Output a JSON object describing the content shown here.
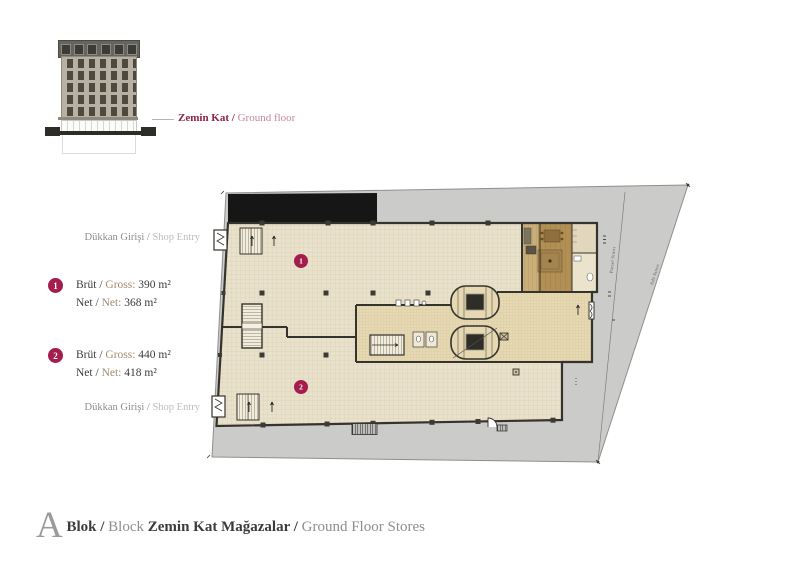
{
  "elevation": {
    "callout_bold": "Zemin Kat /",
    "callout_light": " Ground floor"
  },
  "legend": {
    "items": [
      {
        "number": "1",
        "line1_dark": "Brüt / ",
        "line1_light": "Gross: ",
        "line1_value": "390 m²",
        "line2_dark": "Net / ",
        "line2_light": "Net: ",
        "line2_value": "368 m²"
      },
      {
        "number": "2",
        "line1_dark": "Brüt / ",
        "line1_light": "Gross: ",
        "line1_value": "440 m²",
        "line2_dark": "Net / ",
        "line2_light": "Net: ",
        "line2_value": "418 m²"
      }
    ]
  },
  "plan": {
    "shop_entry_top_dark": "Dükkan Girişi / ",
    "shop_entry_top_light": "Shop Entry",
    "shop_entry_bottom_dark": "Dükkan Girişi / ",
    "shop_entry_bottom_light": "Shop Entry",
    "boundary_parcel_label": "Parsel Sınırı",
    "boundary_block_label": "Ada Sınırı",
    "markers": [
      {
        "number": "1"
      },
      {
        "number": "2"
      }
    ]
  },
  "footer": {
    "block_letter": "A",
    "bold1": " Blok / ",
    "light1": "Block ",
    "bold2": "Zemin Kat Mağazalar / ",
    "light2": "Ground Floor Stores"
  },
  "colors": {
    "accent_crimson": "#a41e4d",
    "callout_maroon": "#8e2344",
    "floor_beige": "#e9e1cb",
    "core_beige": "#e5d8b2",
    "wood_brown": "#b29055",
    "pavement_gray": "#cbcbca",
    "canopy_black": "#161616",
    "wall_dark": "#35332d"
  }
}
